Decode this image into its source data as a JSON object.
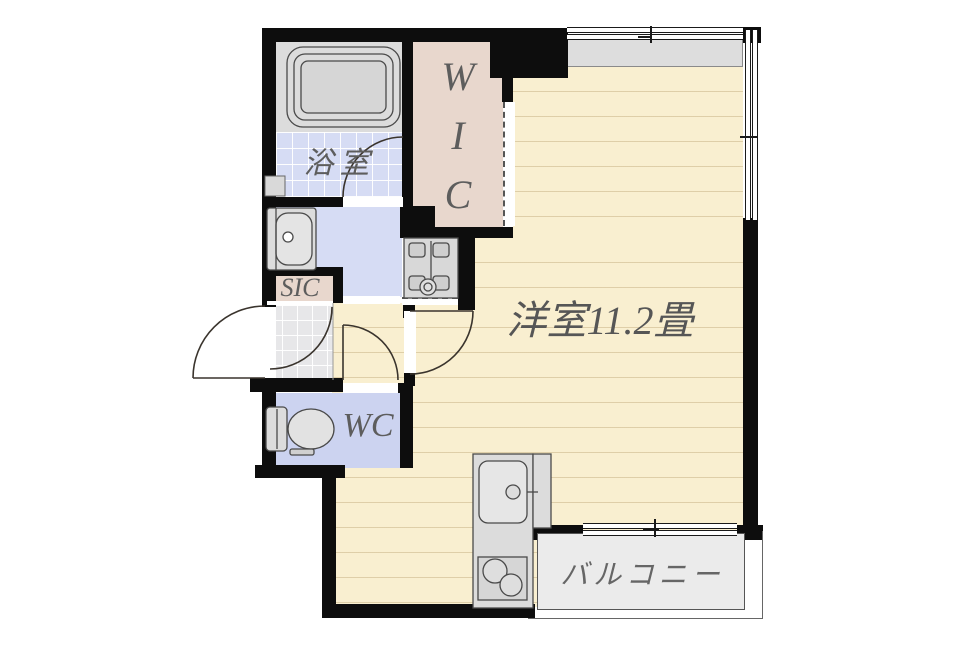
{
  "palette": {
    "wall": "#0d0d0d",
    "floor_wood": "#f9efd0",
    "floor_tile_blue": "#d6dcf4",
    "floor_blue_plain": "#ccd3f0",
    "closet_beige": "#e8d7cd",
    "entry_gray": "#e7e7e9",
    "balcony_gray": "#ebebeb",
    "ledge_gray": "#dddddd",
    "fixture_gray": "#dcdcdc",
    "label_gray": "#5d5d5d"
  },
  "rooms": {
    "main": {
      "label": "洋室11.2畳"
    },
    "bath": {
      "label": "浴室"
    },
    "wic": {
      "letters": [
        "W",
        "I",
        "C"
      ]
    },
    "sic": {
      "label": "SIC"
    },
    "wc": {
      "label": "WC"
    },
    "balcony": {
      "label": "バルコニー"
    }
  },
  "fixtures": {
    "bathtub": "bathtub",
    "washbasin": "washbasin",
    "toilet": "toilet",
    "washer_pan": "washing-machine-pan",
    "kitchen_sink": "kitchen-sink",
    "stove": "two-burner-stove"
  }
}
